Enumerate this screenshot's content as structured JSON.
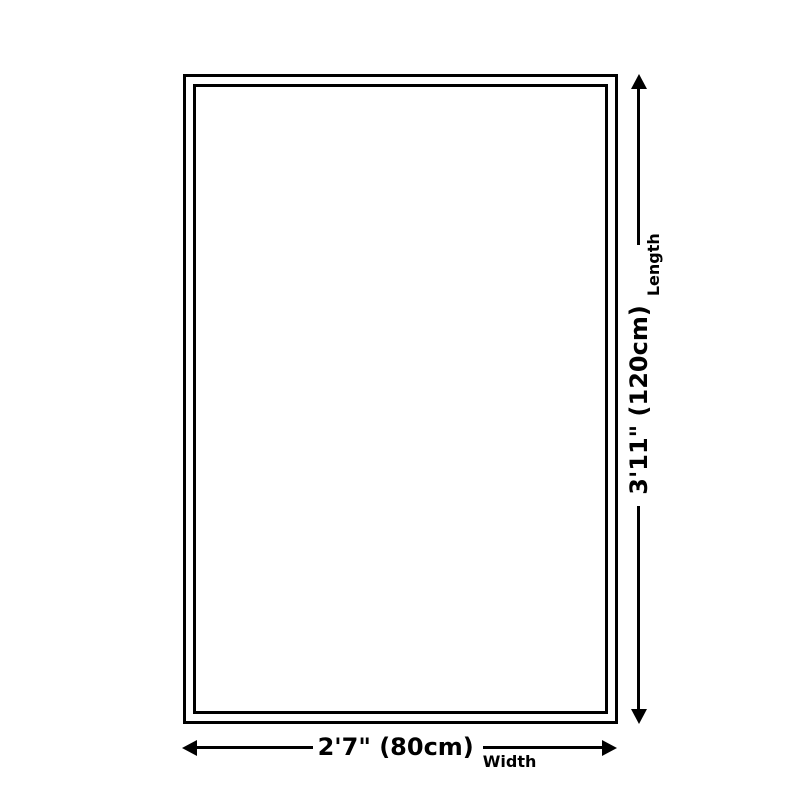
{
  "theme": {
    "background": "#ffffff",
    "line": "#000000",
    "text": "#000000"
  },
  "diagram": {
    "length": {
      "value": "3'11\" (120cm)",
      "axis_label": "Length"
    },
    "width": {
      "value": "2'7\" (80cm)",
      "axis_label": "Width"
    }
  }
}
